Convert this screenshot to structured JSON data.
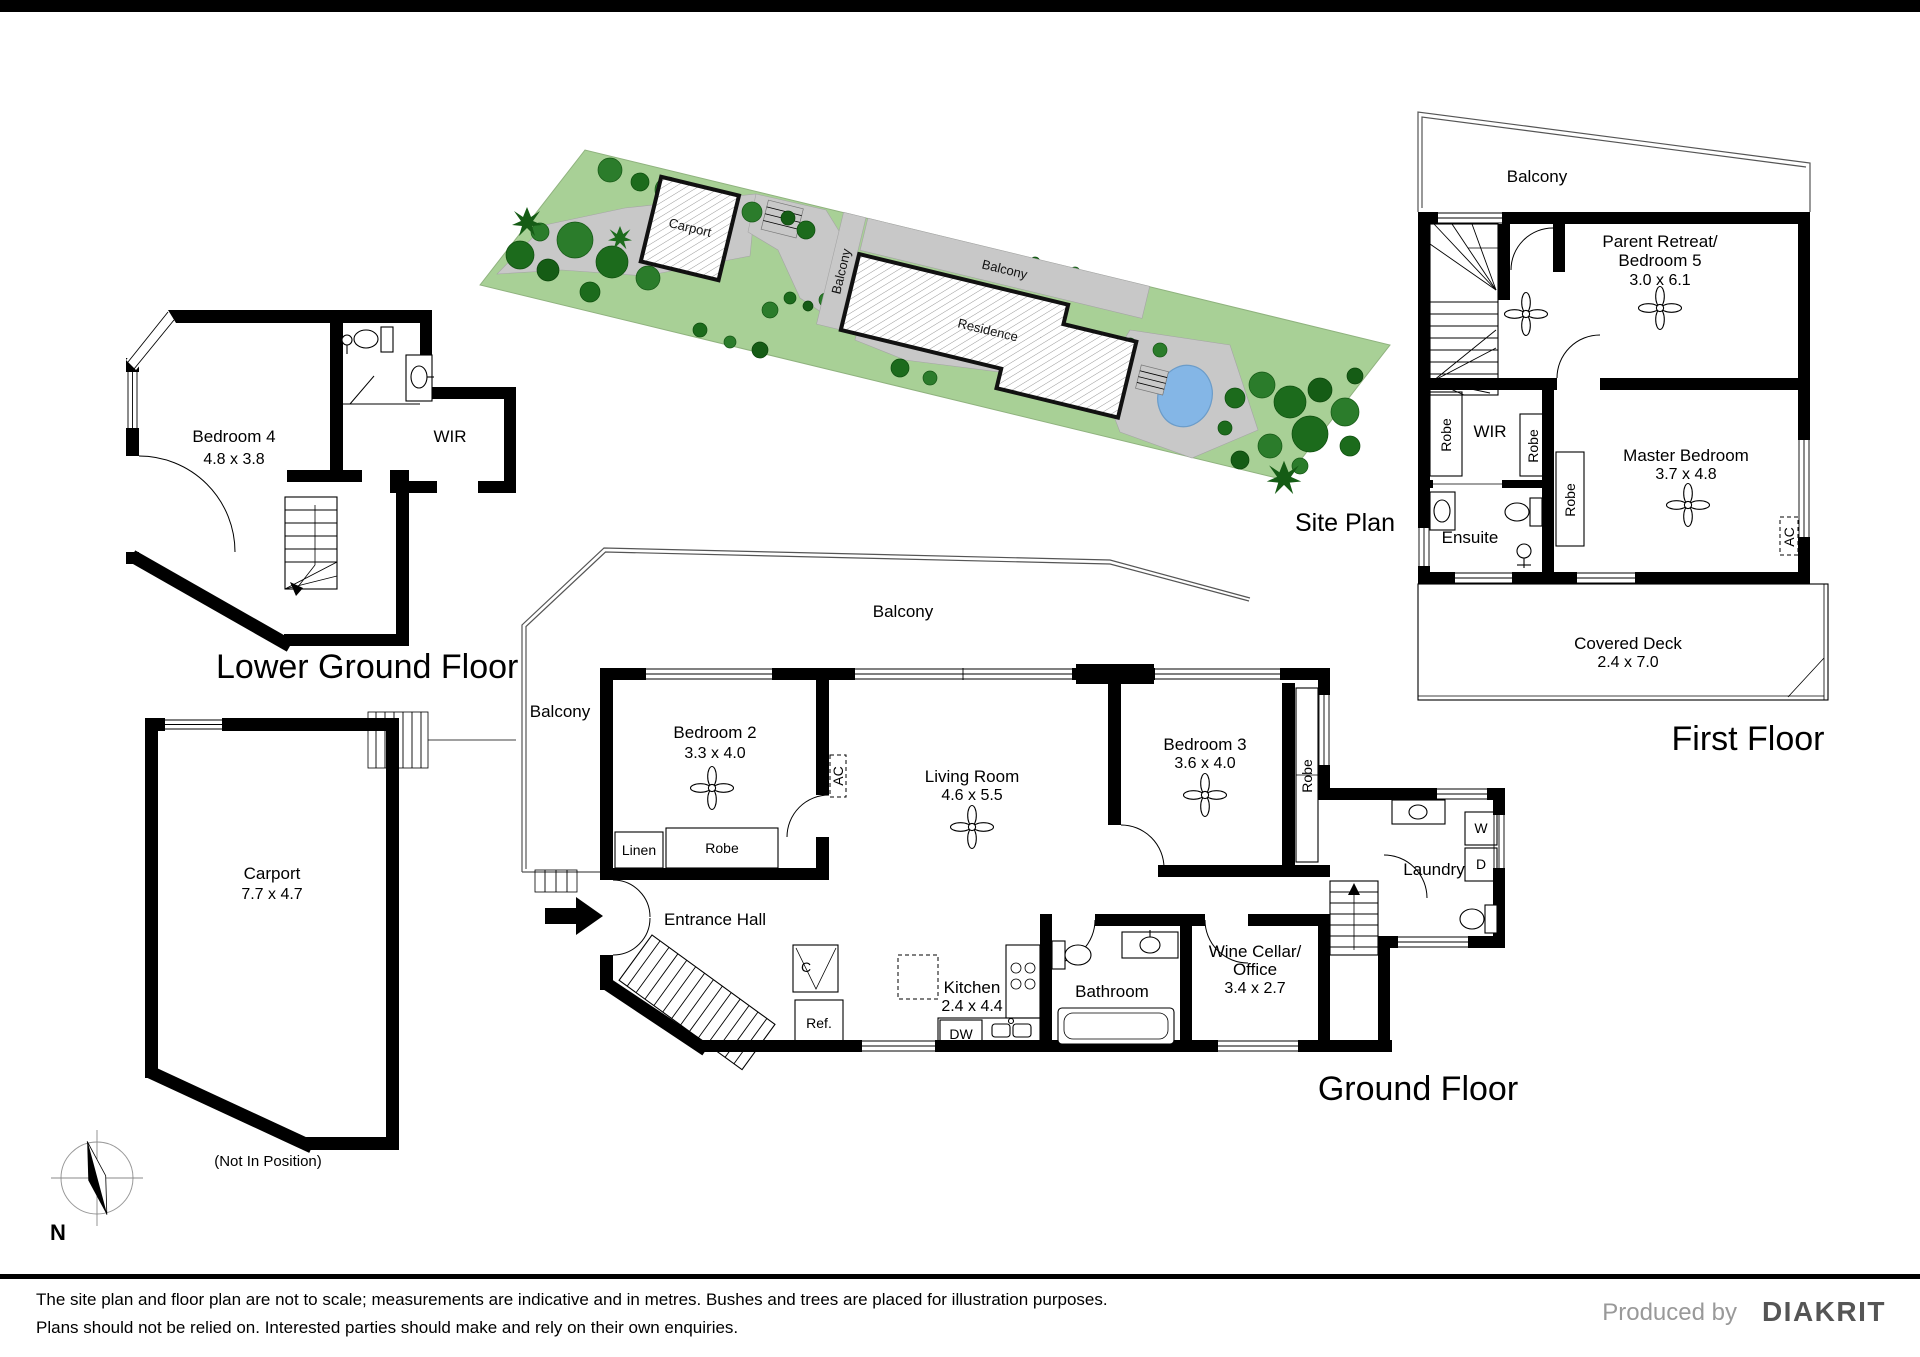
{
  "site_plan": {
    "title": "Site Plan",
    "carport_label": "Carport",
    "balcony_top_label": "Balcony",
    "balcony_side_label": "Balcony",
    "residence_label": "Residence"
  },
  "lower_ground": {
    "title": "Lower Ground Floor",
    "bedroom4_name": "Bedroom 4",
    "bedroom4_dims": "4.8 x 3.8",
    "wir_label": "WIR"
  },
  "ground": {
    "title": "Ground Floor",
    "balcony_left": "Balcony",
    "balcony_top": "Balcony",
    "bedroom2_name": "Bedroom 2",
    "bedroom2_dims": "3.3 x 4.0",
    "living_name": "Living Room",
    "living_dims": "4.6 x 5.5",
    "bedroom3_name": "Bedroom 3",
    "bedroom3_dims": "3.6 x 4.0",
    "entrance_hall": "Entrance Hall",
    "kitchen_name": "Kitchen",
    "kitchen_dims": "2.4 x 4.4",
    "bathroom": "Bathroom",
    "wine_cellar_line1": "Wine Cellar/",
    "wine_cellar_line2": "Office",
    "wine_cellar_dims": "3.4 x 2.7",
    "laundry": "Laundry",
    "linen": "Linen",
    "robe_bed2": "Robe",
    "robe_bed3": "Robe",
    "c_label": "C",
    "ref_label": "Ref.",
    "dw_label": "DW",
    "w_label": "W",
    "d_label": "D",
    "ac_bed2": "AC"
  },
  "first": {
    "title": "First Floor",
    "balcony": "Balcony",
    "retreat_line1": "Parent Retreat/",
    "retreat_line2": "Bedroom 5",
    "retreat_dims": "3.0 x 6.1",
    "master_name": "Master Bedroom",
    "master_dims": "3.7 x 4.8",
    "wir": "WIR",
    "ensuite": "Ensuite",
    "robe1": "Robe",
    "robe2": "Robe",
    "robe3": "Robe",
    "ac": "AC",
    "deck_name": "Covered Deck",
    "deck_dims": "2.4 x 7.0"
  },
  "carport_plan": {
    "name": "Carport",
    "dims": "7.7 x 4.7",
    "note": "(Not In Position)"
  },
  "compass": {
    "north_label": "N"
  },
  "footer": {
    "disclaimer_line1": "The site plan and floor plan are not to scale; measurements are indicative and in metres. Bushes and trees are placed for illustration purposes.",
    "disclaimer_line2": "Plans should not be relied on. Interested parties should make and rely on their own enquiries.",
    "produced_by": "Produced by",
    "brand": "DIAKRIT"
  },
  "colors": {
    "grass": "#a8d096",
    "tree_dark": "#1c6b1c",
    "path_gray": "#c8c8c8",
    "pool_blue": "#84b6e6",
    "wall_black": "#000000"
  }
}
